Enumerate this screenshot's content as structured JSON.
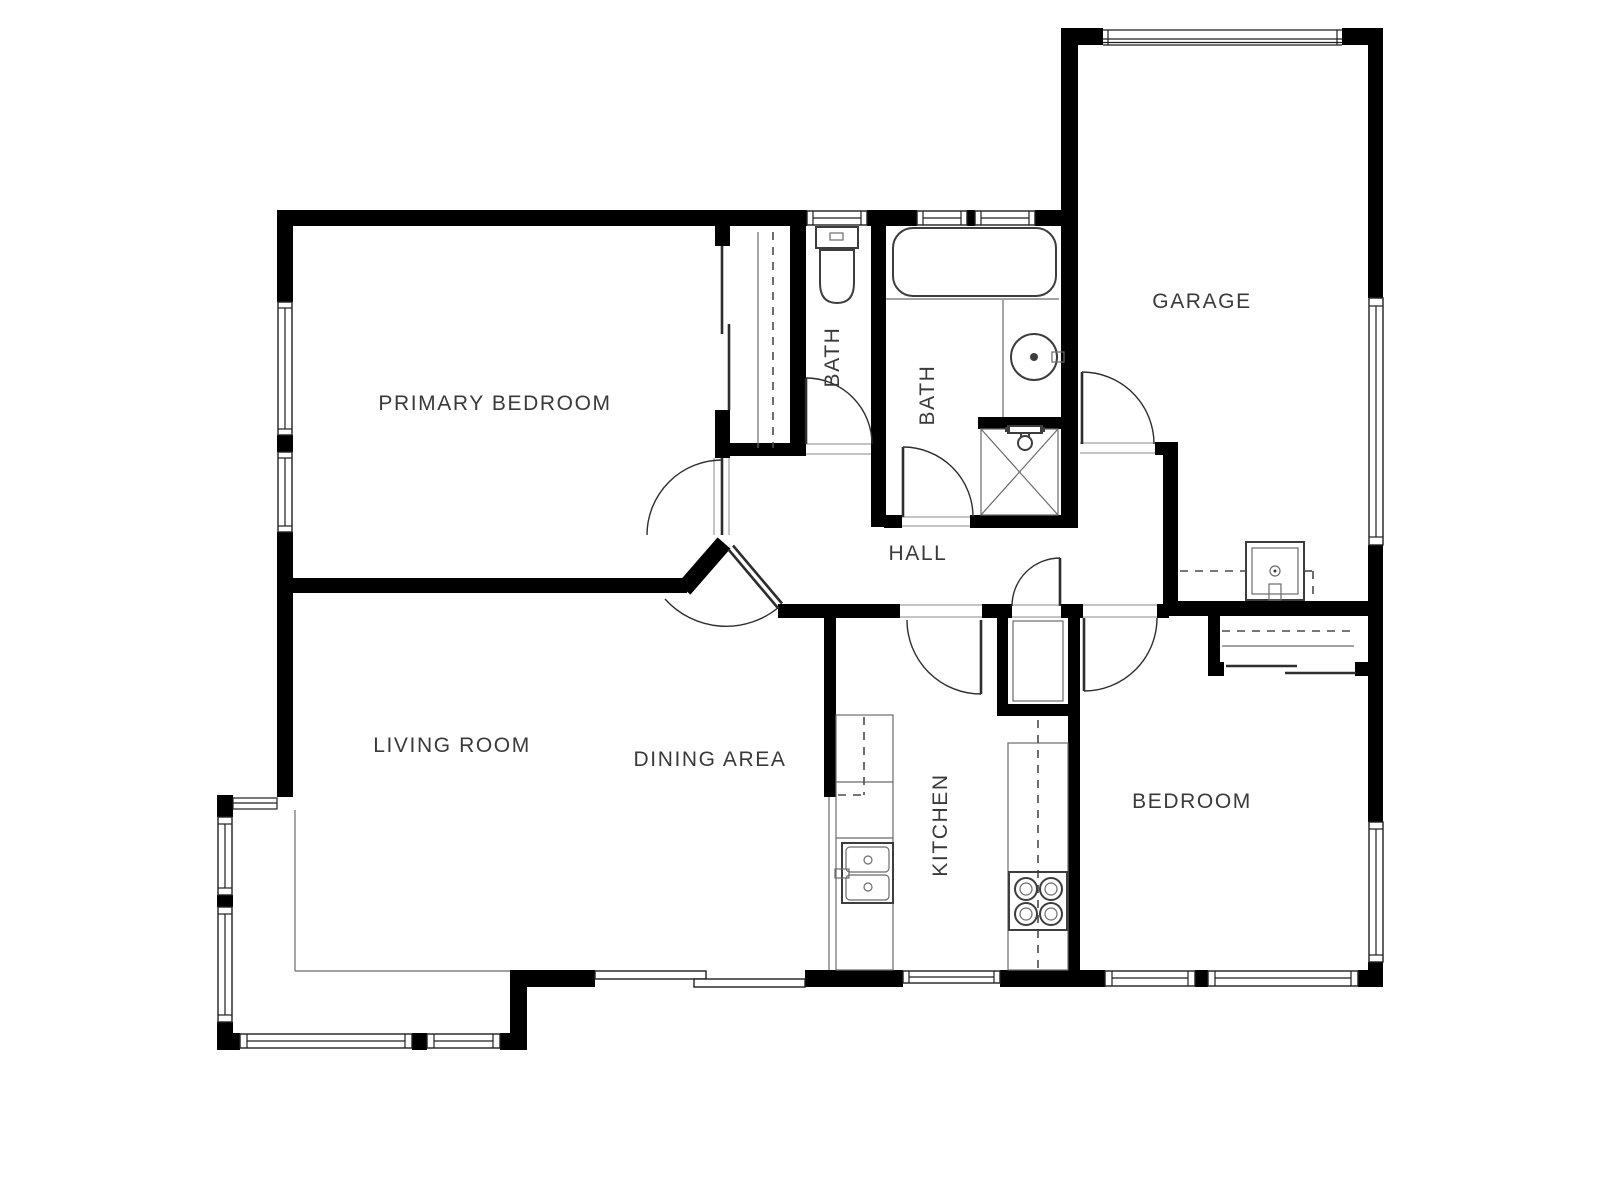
{
  "floorplan": {
    "title": "house-floor-plan",
    "rooms": {
      "primary_bedroom": {
        "label": "PRIMARY BEDROOM"
      },
      "bath1": {
        "label": "BATH"
      },
      "bath2": {
        "label": "BATH"
      },
      "garage": {
        "label": "GARAGE"
      },
      "hall": {
        "label": "HALL"
      },
      "living_room": {
        "label": "LIVING ROOM"
      },
      "dining_area": {
        "label": "DINING AREA"
      },
      "kitchen": {
        "label": "KITCHEN"
      },
      "bedroom": {
        "label": "BEDROOM"
      }
    },
    "colors": {
      "wall": "#000000",
      "fixture_stroke": "#3d3d3d",
      "label_text": "#3a3a3a",
      "background": "#ffffff"
    }
  }
}
